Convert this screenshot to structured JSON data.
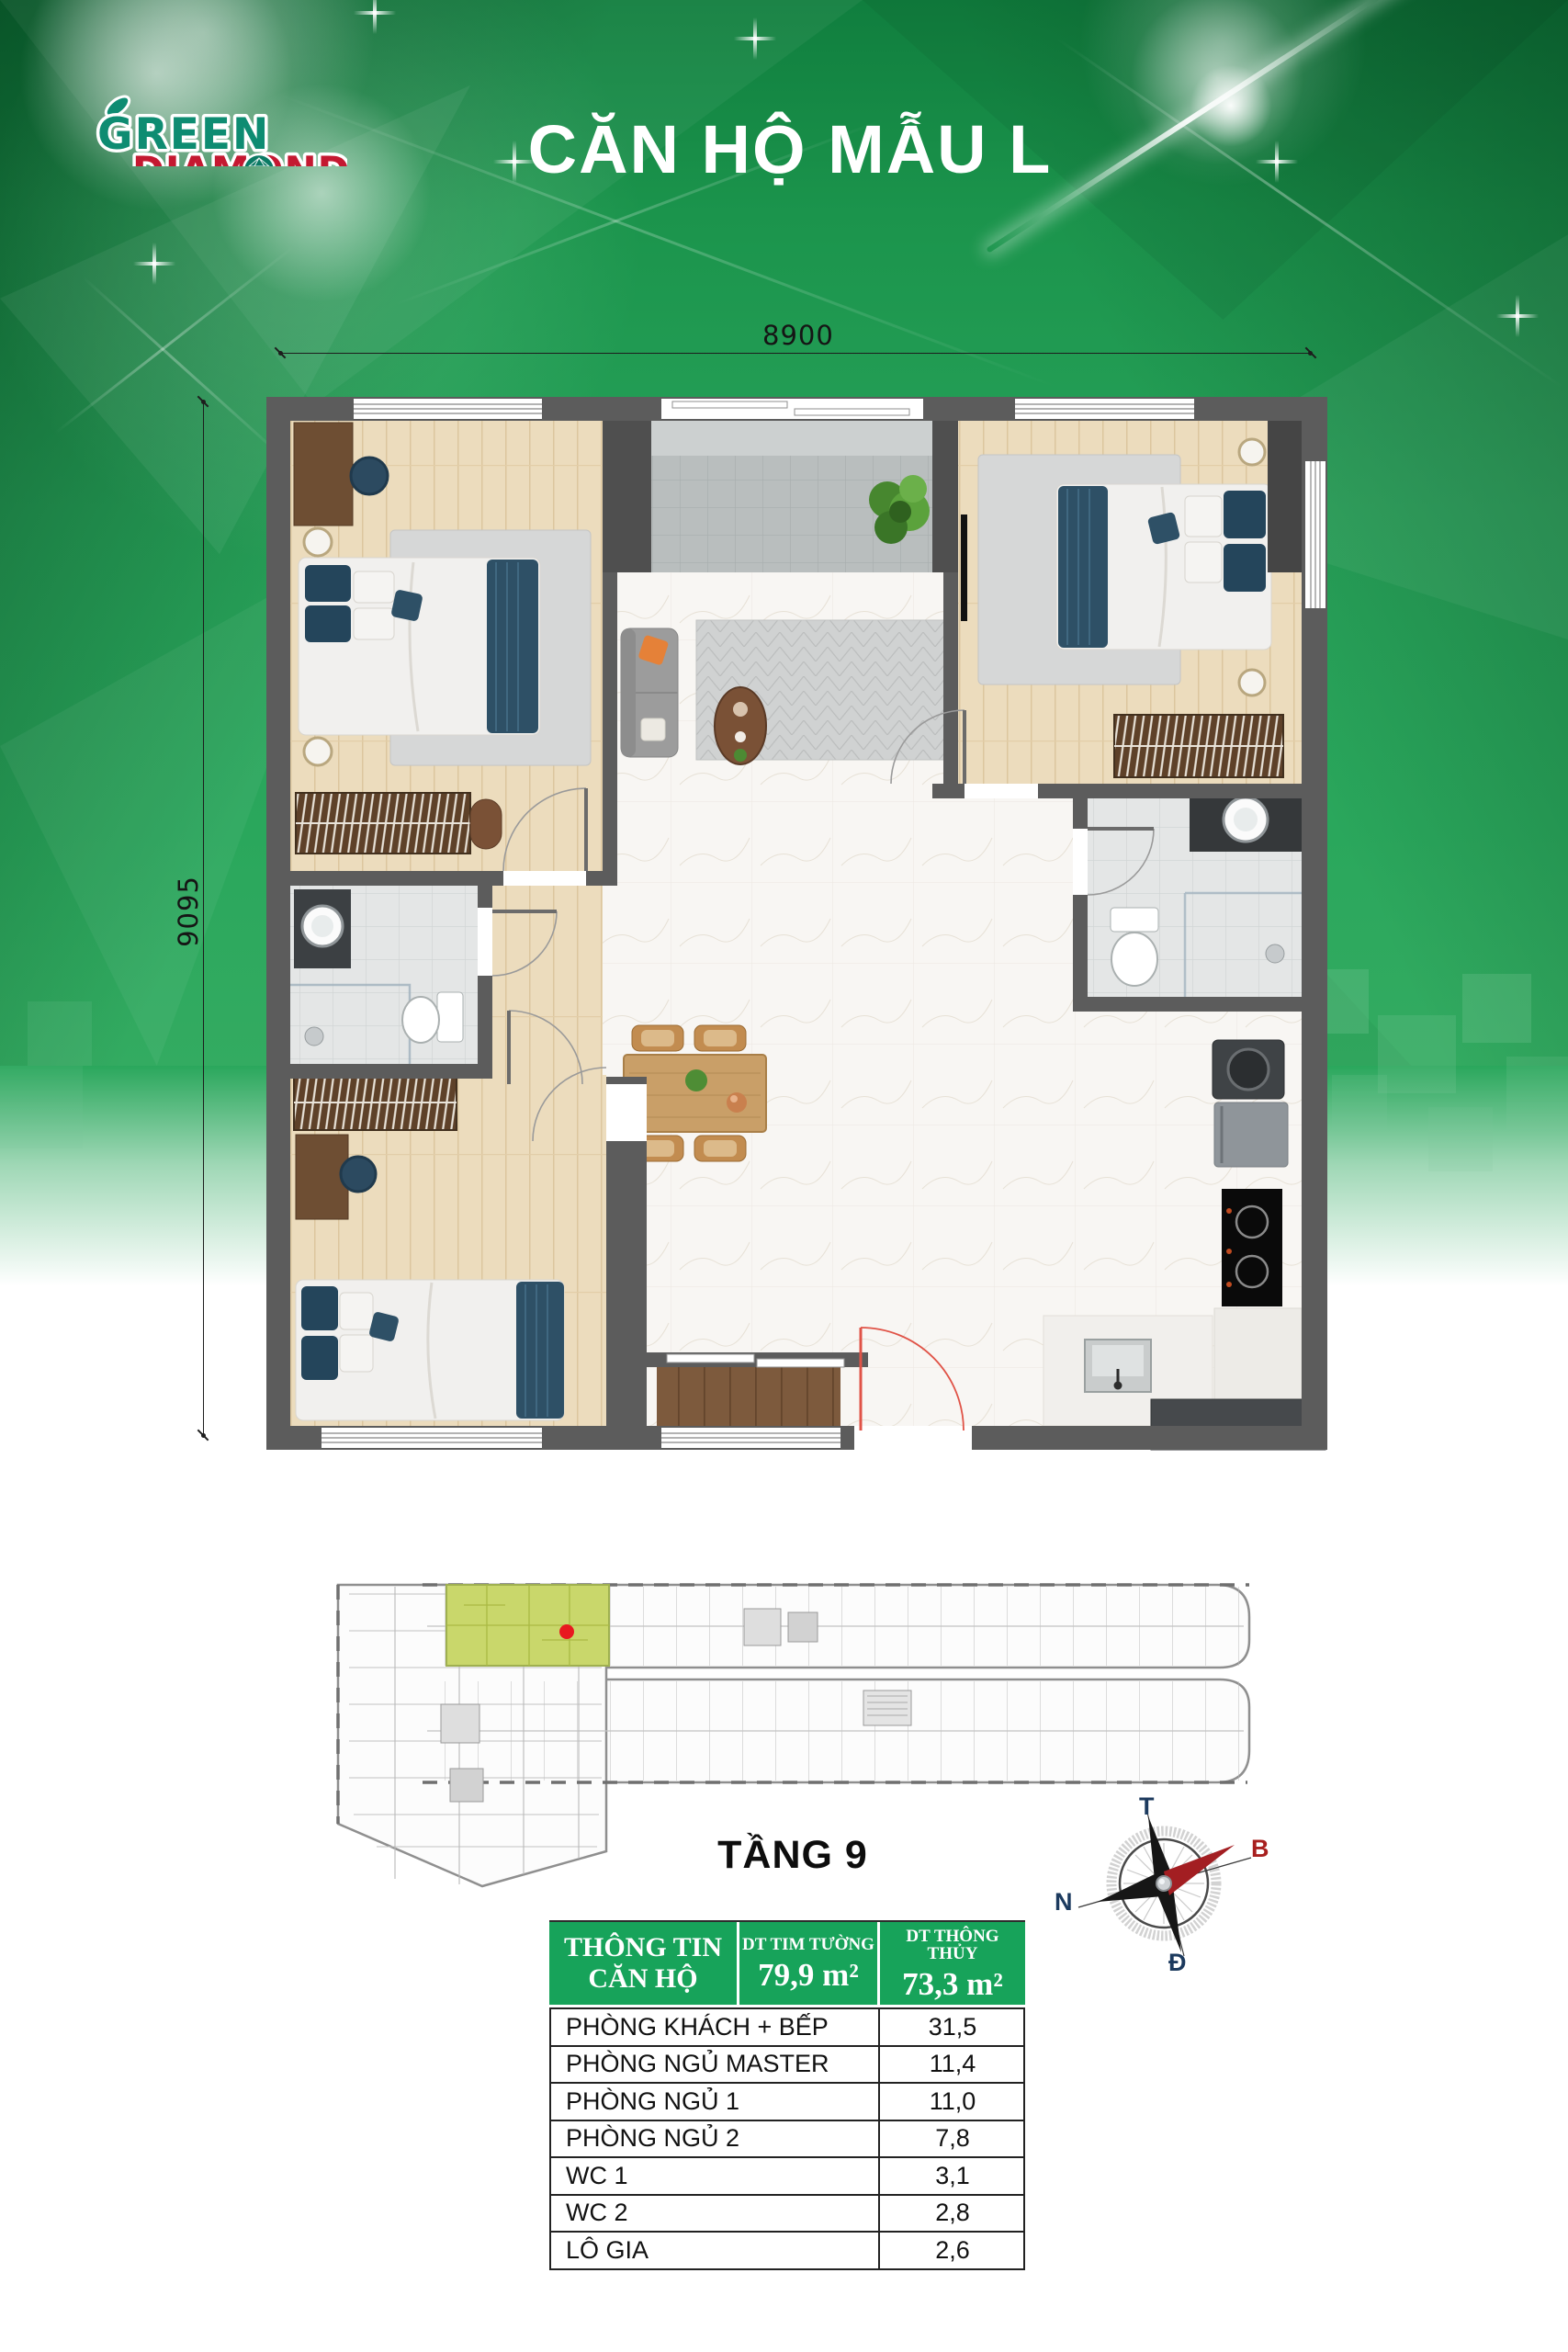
{
  "brand": {
    "name_line1": "GREEN",
    "name_line2": "DIAMOND"
  },
  "title": "CĂN HỘ MẪU L",
  "plan": {
    "width_dim": "8900",
    "height_dim": "9095"
  },
  "floor_strip": {
    "label": "TẦNG 9"
  },
  "compass": {
    "top": "T",
    "right": "B",
    "left": "N",
    "bottom": "Đ"
  },
  "info_table": {
    "header": {
      "info": "THÔNG TIN CĂN HỘ",
      "col2_label": "DT TIM TƯỜNG",
      "col2_value": "79,9 m²",
      "col3_label": "DT THÔNG THỦY",
      "col3_value": "73,3 m²"
    },
    "rows": [
      {
        "label": "PHÒNG KHÁCH + BẾP",
        "value": "31,5"
      },
      {
        "label": "PHÒNG NGỦ MASTER",
        "value": "11,4"
      },
      {
        "label": "PHÒNG NGỦ 1",
        "value": "11,0"
      },
      {
        "label": "PHÒNG NGỦ 2",
        "value": "7,8"
      },
      {
        "label": "WC 1",
        "value": "3,1"
      },
      {
        "label": "WC 2",
        "value": "2,8"
      },
      {
        "label": "LÔ GIA",
        "value": "2,6"
      }
    ]
  },
  "colors": {
    "background_green": "#23a35a",
    "table_header_green": "#17a35a",
    "unit_highlight": "#c9d76b",
    "unit_marker_red": "#e8191f",
    "logo_teal": "#0e8c72",
    "logo_red": "#c41931",
    "compass_navy": "#1c3a5e",
    "compass_red": "#a8201f"
  }
}
